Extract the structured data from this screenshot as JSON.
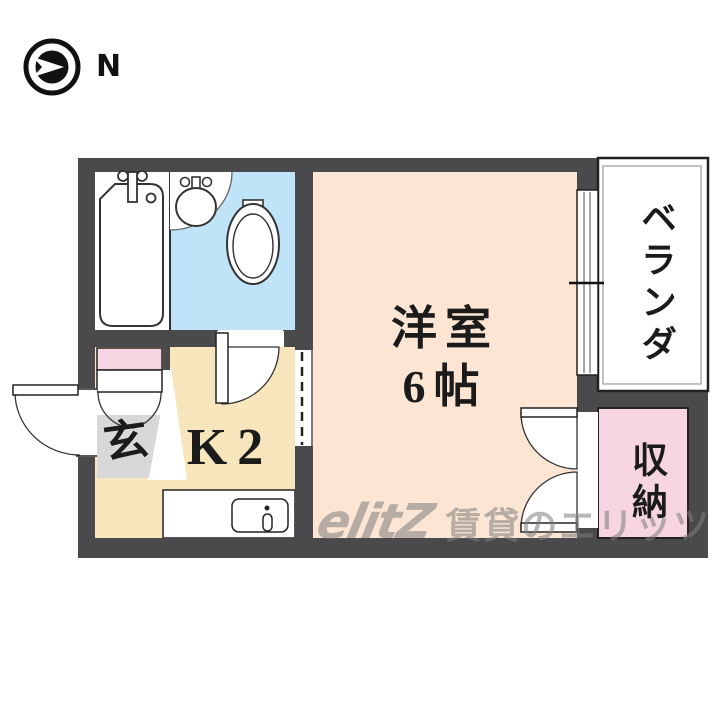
{
  "compass": {
    "label": "N"
  },
  "floor_plan": {
    "rooms": {
      "main_room": {
        "name": "洋室",
        "size": "6帖"
      },
      "kitchen": {
        "label": "K2"
      },
      "entrance": {
        "label": "玄"
      },
      "veranda": {
        "label": "ベランダ"
      },
      "storage": {
        "label": "収納"
      }
    },
    "fixture_icons": [
      "bathtub-icon",
      "washbasin-icon",
      "toilet-icon",
      "kitchen-sink-icon",
      "door-swing-icon",
      "double-closet-door-icon",
      "sliding-window-icon",
      "compass-icon"
    ],
    "colors": {
      "wall": "#4a4a4c",
      "main_room": "#fce5d3",
      "kitchen": "#f7e6bb",
      "washroom": "#bfe3f7",
      "pink": "#f6d4e2",
      "entrance_gray": "#d8d8d8",
      "outline": "#222222"
    }
  },
  "watermark": {
    "logo": "elitZ",
    "text": "賃貸のエリッツ"
  }
}
